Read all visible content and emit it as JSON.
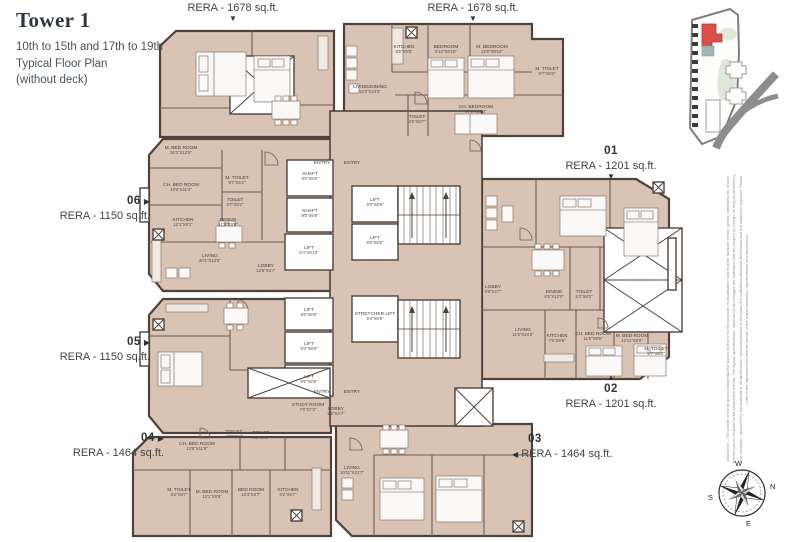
{
  "title": {
    "main": "Tower 1",
    "line1": "10th to 15th and 17th to 19th",
    "line2": "Typical Floor Plan",
    "line3": "(without deck)"
  },
  "icons": {
    "arrow_down": "▼",
    "arrow_up": "▲",
    "arrow_left": "◀",
    "arrow_right": "▶"
  },
  "callouts": {
    "top_left_area": "RERA - 1678 sq.ft.",
    "top_right_area": "RERA - 1678 sq.ft.",
    "unit01": {
      "num": "01",
      "area": "RERA - 1201 sq.ft."
    },
    "unit02": {
      "num": "02",
      "area": "RERA - 1201 sq.ft."
    },
    "unit03": {
      "num": "03",
      "area": "RERA - 1464 sq.ft."
    },
    "unit04": {
      "num": "04",
      "area": "RERA - 1464 sq.ft."
    },
    "unit05": {
      "num": "05",
      "area": "RERA - 1150 sq.ft."
    },
    "unit06": {
      "num": "06",
      "area": "RERA - 1150 sq.ft."
    }
  },
  "compass": {
    "n": "N",
    "e": "E",
    "s": "S",
    "w": "W"
  },
  "disclaimer": "Disclaimer - The picture of the proposed residential flat shown herein is for the purpose of visualisation only and the furniture, items / goods, amenities etc. shown therein are not required to be provided in the flat. The layout, specifications, dimensions and images are indicative and are subject to change as may be decided by the company / approved by the authorities. All dimensions / areas mentioned in the plans are unfinished structural dimensions and are subject to approval. Please refer to the agreement for sale for details of the actual amenities, specifications and dimensions.",
  "colors": {
    "floor": "#d8c3b4",
    "wall": "#4f423c",
    "accent_red": "#d9504a",
    "keymap_green": "#dfe7d9",
    "road_gray": "#8d8d8d",
    "text": "#3f4348"
  },
  "rooms": [
    {
      "label": "M. BED ROOM",
      "dim": "16'3\"X12'5\"",
      "x": 181,
      "y": 149
    },
    {
      "label": "CH. BED ROOM",
      "dim": "12'0\"X11'2\"",
      "x": 181,
      "y": 186
    },
    {
      "label": "M. TOILET",
      "dim": "8'7\"X5'2\"",
      "x": 237,
      "y": 179
    },
    {
      "label": "TOILET",
      "dim": "8'7\"X5'2\"",
      "x": 235,
      "y": 201
    },
    {
      "label": "KITCHEN",
      "dim": "12'1\"X8'1\"",
      "x": 183,
      "y": 221
    },
    {
      "label": "DINING",
      "dim": "11'5\"X9'8\"",
      "x": 228,
      "y": 221
    },
    {
      "label": "LIVING",
      "dim": "20'1\"X12'5\"",
      "x": 210,
      "y": 257
    },
    {
      "label": "LOBBY",
      "dim": "12'5\"X6'7\"",
      "x": 266,
      "y": 267
    },
    {
      "label": "SHAFT",
      "dim": "9'0\"X6'6\"",
      "x": 310,
      "y": 175
    },
    {
      "label": "SHAFT",
      "dim": "9'0\"X6'6\"",
      "x": 310,
      "y": 212
    },
    {
      "label": "LIFT",
      "dim": "9'4\"X8'10\"",
      "x": 309,
      "y": 249
    },
    {
      "label": "LIFT",
      "dim": "9'0\"X8'8\"",
      "x": 375,
      "y": 201
    },
    {
      "label": "LIFT",
      "dim": "9'0\"X8'8\"",
      "x": 375,
      "y": 239
    },
    {
      "label": "LIFT",
      "dim": "9'0\"X8'8\"",
      "x": 309,
      "y": 311
    },
    {
      "label": "LIFT",
      "dim": "9'0\"X8'8\"",
      "x": 309,
      "y": 345
    },
    {
      "label": "LIFT",
      "dim": "9'0\"X8'8\"",
      "x": 309,
      "y": 378
    },
    {
      "label": "STRETCHER LIFT",
      "dim": "9'4\"X8'8\"",
      "x": 375,
      "y": 315
    },
    {
      "label": "STUDY ROOM",
      "dim": "7'0\"X7'2\"",
      "x": 308,
      "y": 406
    },
    {
      "label": "LOBBY",
      "dim": "9'8\"X4'7\"",
      "x": 336,
      "y": 410
    },
    {
      "label": "ENTRY",
      "dim": "",
      "x": 322,
      "y": 164
    },
    {
      "label": "ENTRY",
      "dim": "",
      "x": 352,
      "y": 164
    },
    {
      "label": "ENTRY",
      "dim": "",
      "x": 322,
      "y": 393
    },
    {
      "label": "ENTRY",
      "dim": "",
      "x": 352,
      "y": 393
    },
    {
      "label": "KITCHEN",
      "dim": "8'5\"X9'8\"",
      "x": 404,
      "y": 48
    },
    {
      "label": "BEDROOM",
      "dim": "9'10\"X9'10\"",
      "x": 446,
      "y": 48
    },
    {
      "label": "M. BEDROOM",
      "dim": "12'5\"X9'10\"",
      "x": 492,
      "y": 48
    },
    {
      "label": "M. TOILET",
      "dim": "9'7\"X5'0\"",
      "x": 547,
      "y": 70
    },
    {
      "label": "LIVING/DINING",
      "dim": "12'0\"X24'5\"",
      "x": 370,
      "y": 88
    },
    {
      "label": "TOILET",
      "dim": "4'9\"X8'7\"",
      "x": 417,
      "y": 118
    },
    {
      "label": "CH. BEDROOM",
      "dim": "17'1\"X12'4\"",
      "x": 476,
      "y": 108
    },
    {
      "label": "LOBBY",
      "dim": "9'8\"X4'7\"",
      "x": 493,
      "y": 288
    },
    {
      "label": "DINING",
      "dim": "8'5\"X12'0\"",
      "x": 554,
      "y": 293
    },
    {
      "label": "TOILET",
      "dim": "5'3\"X8'0\"",
      "x": 584,
      "y": 293
    },
    {
      "label": "LIVING",
      "dim": "11'5\"X24'5\"",
      "x": 523,
      "y": 331
    },
    {
      "label": "KITCHEN",
      "dim": "7'6\"X9'8\"",
      "x": 557,
      "y": 337
    },
    {
      "label": "CH. BED ROOM",
      "dim": "11'5\"X9'8\"",
      "x": 593,
      "y": 335
    },
    {
      "label": "M. BED ROOM",
      "dim": "10'11\"X9'8\"",
      "x": 632,
      "y": 337
    },
    {
      "label": "M. TOILET",
      "dim": "8'7\"X5'0\"",
      "x": 656,
      "y": 350
    },
    {
      "label": "CH. BED ROOM",
      "dim": "12'6\"X11'9\"",
      "x": 197,
      "y": 445
    },
    {
      "label": "TOILET",
      "dim": "9'8\"X5'4\"",
      "x": 234,
      "y": 433
    },
    {
      "label": "TOILET",
      "dim": "4'9\"X8'0\"",
      "x": 261,
      "y": 434
    },
    {
      "label": "M. TOILET",
      "dim": "5'2\"X8'7\"",
      "x": 179,
      "y": 491
    },
    {
      "label": "M. BED ROOM",
      "dim": "12'1\"X9'8\"",
      "x": 212,
      "y": 493
    },
    {
      "label": "BED ROOM",
      "dim": "10'3\"X9'7\"",
      "x": 251,
      "y": 491
    },
    {
      "label": "KITCHEN",
      "dim": "8'2\"X9'7\"",
      "x": 288,
      "y": 491
    },
    {
      "label": "LIVING",
      "dim": "10'11\"X21'7\"",
      "x": 352,
      "y": 469
    }
  ]
}
